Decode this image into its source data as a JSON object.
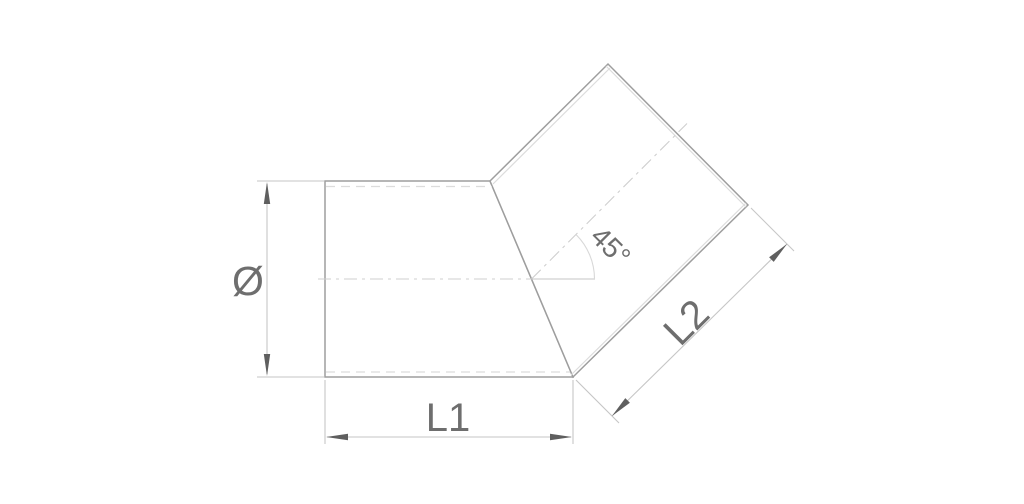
{
  "drawing": {
    "labels": {
      "diameter": "Ø",
      "l1": "L1",
      "l2": "L2",
      "angle": "45°"
    },
    "colors": {
      "background": "#ffffff",
      "outline": "#9e9e9e",
      "inner_edge": "#dcdcdc",
      "centerline": "#cfcfcf",
      "dimension_line": "#c6c6c6",
      "arrowhead": "#5f5f5f",
      "label_text": "#6e6e6e"
    }
  }
}
